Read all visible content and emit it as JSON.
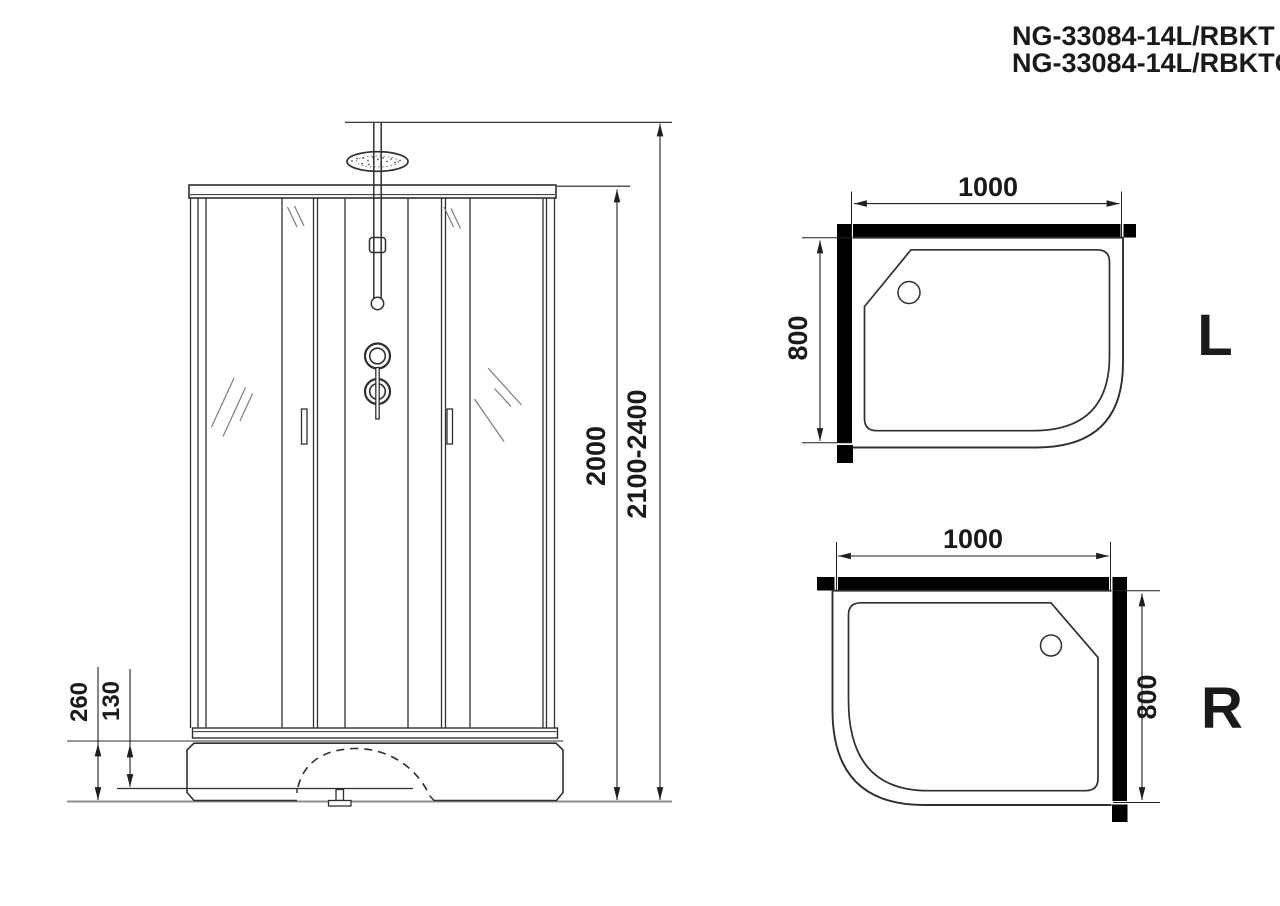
{
  "header": {
    "model_line1": "NG-33084-14L/RBKT",
    "model_line2": "NG-33084-14L/RBKTG"
  },
  "front_view": {
    "dim_total_height": "2100-2400",
    "dim_cabin_height": "2000",
    "dim_tray_height": "260",
    "dim_tray_step": "130"
  },
  "top_view_l": {
    "dim_width": "1000",
    "dim_depth": "800",
    "variant_label": "L"
  },
  "top_view_r": {
    "dim_width": "1000",
    "dim_depth": "800",
    "variant_label": "R"
  },
  "colors": {
    "line": "#2f2f2f",
    "dim_line": "#1f1f1f",
    "wall_fill": "#000000",
    "ground": "#8f8f8f",
    "reflection": "#7d7d7d",
    "background": "#ffffff"
  }
}
